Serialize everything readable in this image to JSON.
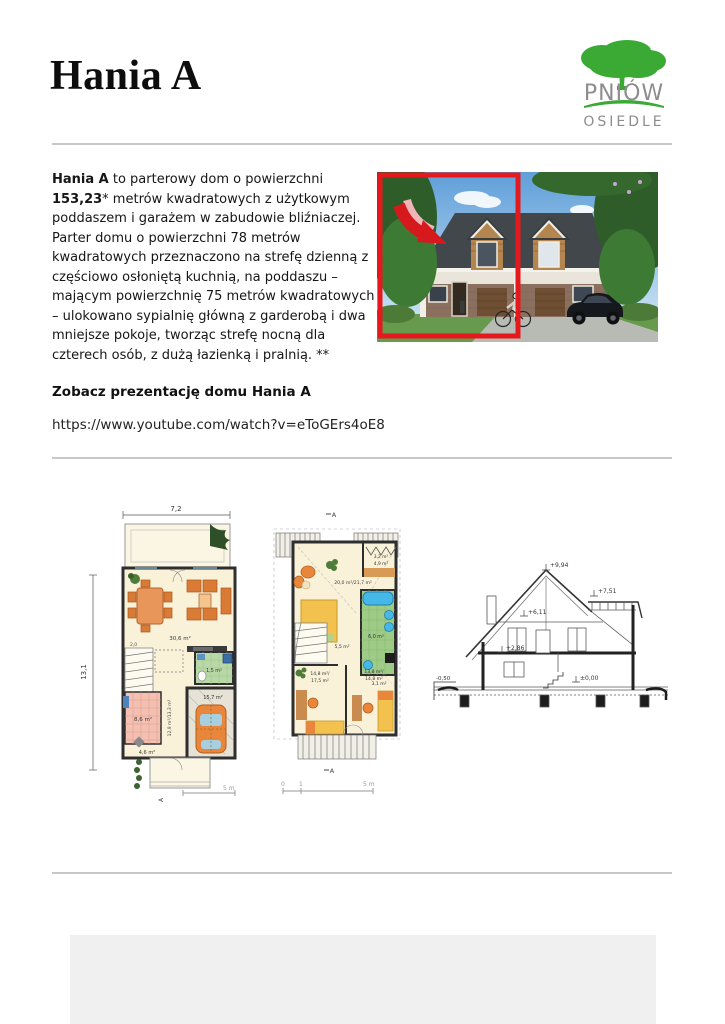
{
  "header": {
    "title": "Hania A",
    "logo": {
      "brand": "PNIÓW",
      "sub": "OSIEDLE",
      "green": "#3aaa35",
      "gray": "#8d8d8d"
    }
  },
  "description": {
    "lead": "Hania A",
    "t1": " to parterowy dom o powierzchni ",
    "area": "153,23",
    "t2": "* metrów kwadratowych z użytkowym poddaszem i garażem w zabudowie bliźniaczej. Parter domu o powierzchni 78 metrów kwadratowych przeznaczono na strefę dzienną z częściowo osłoniętą kuchnią, na poddaszu – mającym powierzchnię 75 metrów kwadratowych – ulokowano sypialnię główną z garderobą i dwa mniejsze pokoje, tworząc strefę nocną dla czterech osób, z dużą łazienką i pralnią. **"
  },
  "photo": {
    "highlight_color": "#e5191d"
  },
  "video": {
    "heading": "Zobacz prezentację domu Hania A",
    "url": "https://www.youtube.com/watch?v=eToGErs4oE8"
  },
  "plans": {
    "ground": {
      "dim_w": "7,2",
      "dim_h": "13,1",
      "living": "30,6 m²",
      "wc": "1,5 m²",
      "stairs": "2,0",
      "kitchen": "8,6 m²",
      "corridor": "12,9 m²/13,3 m²",
      "garage": "15,7 m²",
      "hall": "4,6 m²",
      "scale": "5 m",
      "marker": "A"
    },
    "upper": {
      "bedroom": "20,0 m²/21,7 m²",
      "wardrobe_a": "3,2 m²",
      "wardrobe_b": "4,9 m²",
      "bath": "6,0 m²",
      "hall": "5,5 m²",
      "laundry": "3,1 m²",
      "room_left_a": "14,8 m²/",
      "room_left_b": "17,5 m²",
      "room_right_a": "13,8 m²/",
      "room_right_b": "14,8 m²",
      "scale_0": "0",
      "scale_1": "1",
      "scale_end": "5 m",
      "marker": "A"
    },
    "section": {
      "ridge": "+9,94",
      "dormer": "+7,51",
      "attic": "+6,11",
      "floor": "+2,86",
      "zero": "±0,00",
      "terrain": "-0,50"
    }
  }
}
